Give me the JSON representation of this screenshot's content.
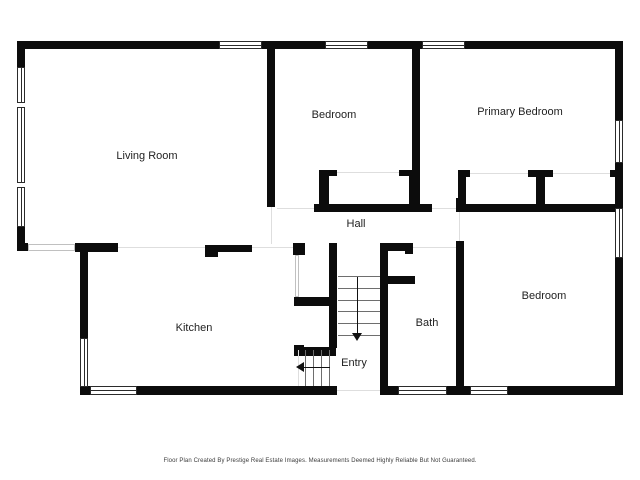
{
  "colors": {
    "wall": "#0c0c0c",
    "window_border": "#2b2b2b",
    "opening_line": "#dedede",
    "tread": "#6e6e6e",
    "arrow": "#111111",
    "label_text": "#1f1f1f",
    "footer_text": "#3c3c3c",
    "background": "#ffffff"
  },
  "footer": {
    "text": "Floor Plan Created By Prestige Real Estate Images. Measurements Deemed Highly Reliable But Not Guaranteed.",
    "y": 458
  },
  "rooms": [
    {
      "name": "living-room",
      "label": "Living Room",
      "x": 147,
      "y": 156
    },
    {
      "name": "bedroom-top",
      "label": "Bedroom",
      "x": 334,
      "y": 115
    },
    {
      "name": "primary-bedroom",
      "label": "Primary Bedroom",
      "x": 520,
      "y": 112
    },
    {
      "name": "hall",
      "label": "Hall",
      "x": 356,
      "y": 224
    },
    {
      "name": "kitchen",
      "label": "Kitchen",
      "x": 194,
      "y": 328
    },
    {
      "name": "bath",
      "label": "Bath",
      "x": 427,
      "y": 323
    },
    {
      "name": "entry",
      "label": "Entry",
      "x": 354,
      "y": 363
    },
    {
      "name": "bedroom-bottom",
      "label": "Bedroom",
      "x": 544,
      "y": 296
    }
  ],
  "plan": {
    "walls": [
      {
        "x": 17,
        "y": 41,
        "w": 202,
        "h": 8
      },
      {
        "x": 262,
        "y": 41,
        "w": 63,
        "h": 8
      },
      {
        "x": 368,
        "y": 41,
        "w": 54,
        "h": 8
      },
      {
        "x": 465,
        "y": 41,
        "w": 158,
        "h": 8
      },
      {
        "x": 17,
        "y": 41,
        "w": 8,
        "h": 26
      },
      {
        "x": 17,
        "y": 227,
        "w": 8,
        "h": 23
      },
      {
        "x": 17,
        "y": 243,
        "w": 11,
        "h": 8
      },
      {
        "x": 75,
        "y": 243,
        "w": 43,
        "h": 9
      },
      {
        "x": 205,
        "y": 245,
        "w": 13,
        "h": 12
      },
      {
        "x": 218,
        "y": 245,
        "w": 34,
        "h": 7
      },
      {
        "x": 293,
        "y": 243,
        "w": 12,
        "h": 12
      },
      {
        "x": 80,
        "y": 244,
        "w": 8,
        "h": 94
      },
      {
        "x": 80,
        "y": 386,
        "w": 10,
        "h": 9
      },
      {
        "x": 137,
        "y": 386,
        "w": 200,
        "h": 9
      },
      {
        "x": 380,
        "y": 386,
        "w": 18,
        "h": 9
      },
      {
        "x": 447,
        "y": 386,
        "w": 23,
        "h": 9
      },
      {
        "x": 508,
        "y": 386,
        "w": 115,
        "h": 9
      },
      {
        "x": 615,
        "y": 41,
        "w": 8,
        "h": 79
      },
      {
        "x": 615,
        "y": 163,
        "w": 8,
        "h": 45
      },
      {
        "x": 615,
        "y": 258,
        "w": 8,
        "h": 137
      },
      {
        "x": 267,
        "y": 49,
        "w": 8,
        "h": 158
      },
      {
        "x": 412,
        "y": 49,
        "w": 8,
        "h": 163
      },
      {
        "x": 319,
        "y": 170,
        "w": 18,
        "h": 6
      },
      {
        "x": 399,
        "y": 170,
        "w": 15,
        "h": 6
      },
      {
        "x": 319,
        "y": 170,
        "w": 10,
        "h": 42
      },
      {
        "x": 409,
        "y": 170,
        "w": 10,
        "h": 42
      },
      {
        "x": 314,
        "y": 204,
        "w": 118,
        "h": 8
      },
      {
        "x": 456,
        "y": 198,
        "w": 8,
        "h": 14
      },
      {
        "x": 456,
        "y": 204,
        "w": 167,
        "h": 8
      },
      {
        "x": 458,
        "y": 170,
        "w": 12,
        "h": 7
      },
      {
        "x": 528,
        "y": 170,
        "w": 25,
        "h": 7
      },
      {
        "x": 610,
        "y": 170,
        "w": 13,
        "h": 7
      },
      {
        "x": 458,
        "y": 170,
        "w": 8,
        "h": 42
      },
      {
        "x": 536,
        "y": 170,
        "w": 9,
        "h": 42
      },
      {
        "x": 329,
        "y": 243,
        "w": 8,
        "h": 105
      },
      {
        "x": 380,
        "y": 243,
        "w": 8,
        "h": 148
      },
      {
        "x": 388,
        "y": 243,
        "w": 25,
        "h": 8
      },
      {
        "x": 405,
        "y": 243,
        "w": 8,
        "h": 11
      },
      {
        "x": 388,
        "y": 276,
        "w": 27,
        "h": 8
      },
      {
        "x": 294,
        "y": 297,
        "w": 42,
        "h": 9
      },
      {
        "x": 294,
        "y": 345,
        "w": 10,
        "h": 11
      },
      {
        "x": 294,
        "y": 347,
        "w": 42,
        "h": 9
      },
      {
        "x": 456,
        "y": 241,
        "w": 8,
        "h": 145
      }
    ],
    "windows": [
      {
        "x": 219,
        "y": 41,
        "w": 43,
        "h": 8,
        "o": "h"
      },
      {
        "x": 325,
        "y": 41,
        "w": 43,
        "h": 8,
        "o": "h"
      },
      {
        "x": 422,
        "y": 41,
        "w": 43,
        "h": 8,
        "o": "h"
      },
      {
        "x": 17,
        "y": 67,
        "w": 8,
        "h": 36,
        "o": "v"
      },
      {
        "x": 17,
        "y": 107,
        "w": 8,
        "h": 76,
        "o": "v"
      },
      {
        "x": 17,
        "y": 187,
        "w": 8,
        "h": 40,
        "o": "v"
      },
      {
        "x": 80,
        "y": 338,
        "w": 8,
        "h": 49,
        "o": "v"
      },
      {
        "x": 90,
        "y": 386,
        "w": 47,
        "h": 9,
        "o": "h"
      },
      {
        "x": 398,
        "y": 386,
        "w": 49,
        "h": 9,
        "o": "h"
      },
      {
        "x": 470,
        "y": 386,
        "w": 38,
        "h": 9,
        "o": "h"
      },
      {
        "x": 615,
        "y": 120,
        "w": 8,
        "h": 43,
        "o": "v"
      },
      {
        "x": 615,
        "y": 208,
        "w": 8,
        "h": 50,
        "o": "v"
      }
    ],
    "passages": [
      {
        "x": 28,
        "y": 244,
        "w": 47,
        "h": 7
      },
      {
        "x": 295,
        "y": 255,
        "w": 4,
        "h": 42
      }
    ],
    "faint_lines": [
      {
        "x": 118,
        "y": 247,
        "w": 87,
        "h": 1
      },
      {
        "x": 271,
        "y": 207,
        "w": 1,
        "h": 37
      },
      {
        "x": 252,
        "y": 247,
        "w": 41,
        "h": 1
      },
      {
        "x": 277,
        "y": 208,
        "w": 37,
        "h": 1
      },
      {
        "x": 432,
        "y": 208,
        "w": 24,
        "h": 1
      },
      {
        "x": 413,
        "y": 247,
        "w": 43,
        "h": 1
      },
      {
        "x": 459,
        "y": 212,
        "w": 1,
        "h": 29
      },
      {
        "x": 337,
        "y": 390,
        "w": 43,
        "h": 1
      },
      {
        "x": 337,
        "y": 172,
        "w": 62,
        "h": 1
      },
      {
        "x": 470,
        "y": 173,
        "w": 58,
        "h": 1
      },
      {
        "x": 553,
        "y": 173,
        "w": 57,
        "h": 1
      },
      {
        "x": 298,
        "y": 350,
        "w": 1,
        "h": 36
      }
    ],
    "treads": [
      {
        "x": 338,
        "y": 276,
        "w": 42,
        "h": 1
      },
      {
        "x": 338,
        "y": 288,
        "w": 42,
        "h": 1
      },
      {
        "x": 338,
        "y": 300,
        "w": 42,
        "h": 1
      },
      {
        "x": 338,
        "y": 311,
        "w": 42,
        "h": 1
      },
      {
        "x": 338,
        "y": 323,
        "w": 42,
        "h": 1
      },
      {
        "x": 338,
        "y": 335,
        "w": 42,
        "h": 1
      },
      {
        "x": 305,
        "y": 350,
        "w": 1,
        "h": 36
      },
      {
        "x": 313,
        "y": 350,
        "w": 1,
        "h": 36
      },
      {
        "x": 321,
        "y": 350,
        "w": 1,
        "h": 36
      },
      {
        "x": 329,
        "y": 350,
        "w": 1,
        "h": 36
      }
    ],
    "arrows": [
      {
        "name": "stairs-down-arrow",
        "shaft": {
          "x": 357,
          "y": 277,
          "w": 1,
          "h": 57
        },
        "head": {
          "x": 352,
          "y": 333,
          "dir": "down"
        }
      },
      {
        "name": "entry-steps-arrow",
        "shaft": {
          "x": 303,
          "y": 367,
          "w": 27,
          "h": 1
        },
        "head": {
          "x": 296,
          "y": 362,
          "dir": "left"
        }
      }
    ]
  }
}
